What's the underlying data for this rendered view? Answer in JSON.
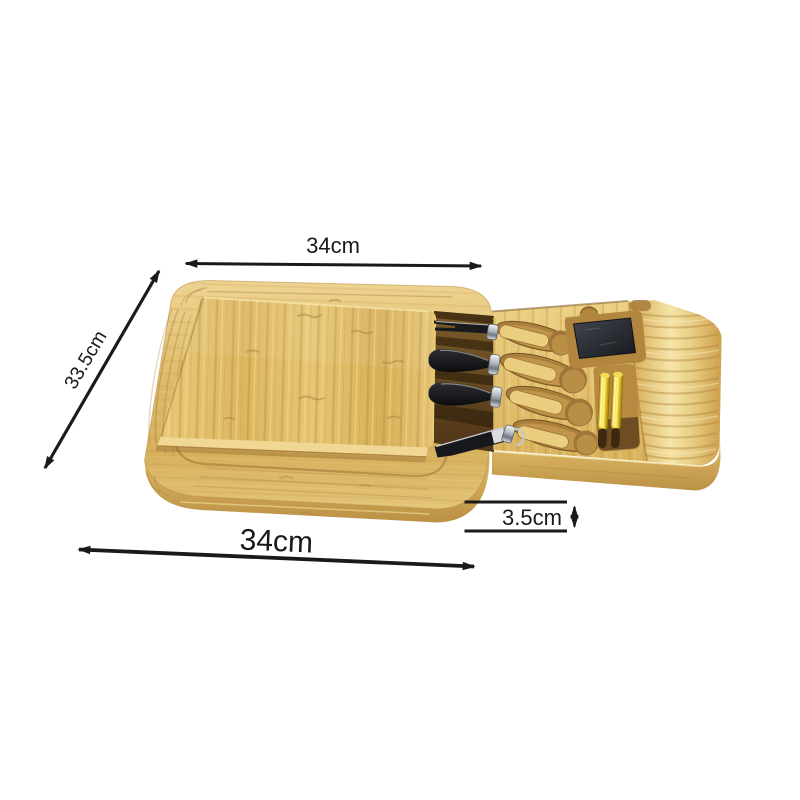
{
  "page": {
    "background": "#ffffff"
  },
  "scene": {
    "subject": "bamboo-cheese-board-with-slide-out-knife-drawer",
    "knife_count": 4,
    "chalk_pen_count": 2,
    "slate_insert": "dark-slate-square",
    "material": "bamboo"
  },
  "annotations": {
    "top_width": "34cm",
    "left_depth": "33.5cm",
    "bottom_width": "34cm",
    "drawer_height": "3.5cm"
  },
  "style": {
    "annotation_color": "#1a1a1a",
    "bamboo_light": "#f2dc96",
    "bamboo_mid": "#e2c06e",
    "bamboo_dark": "#c49a4d",
    "bamboo_shadow": "#8a6530",
    "blade_color": "#141519",
    "ferrule_color": "#c9ced4",
    "slate_color": "#262a30",
    "chalk_pen_yellow": "#e8c91f",
    "pen_tip_brown": "#40290f"
  }
}
